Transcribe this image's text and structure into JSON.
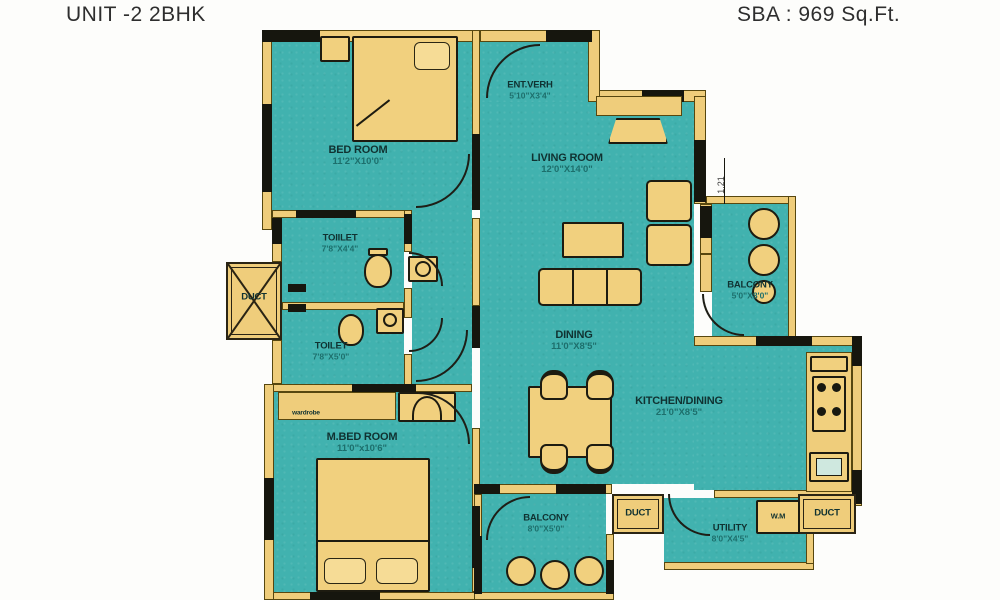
{
  "header": {
    "title": "UNIT -2 2BHK",
    "sba": "SBA : 969 Sq.Ft."
  },
  "colors": {
    "floor_teal": "#41b2af",
    "wall_yellow": "#efcd7b",
    "wall_black": "#16160e",
    "outline_brown": "#57470f",
    "room_label": "#103231",
    "dim_label": "#1d6f6c"
  },
  "rooms": {
    "bedroom": {
      "name": "BED ROOM",
      "dims": "11'2\"X10'0\""
    },
    "entverh": {
      "name": "ENT.VERH",
      "dims": "5'10\"X3'4\""
    },
    "living": {
      "name": "LIVING ROOM",
      "dims": "12'0\"X14'0\""
    },
    "toilet1": {
      "name": "TOIILET",
      "dims": "7'8\"X4'4\""
    },
    "toilet2": {
      "name": "TOILET",
      "dims": "7'8\"X5'0\""
    },
    "duct_left": {
      "name": "DUCT"
    },
    "balcony_right": {
      "name": "BALCONY",
      "dims": "5'0\"X8'0\""
    },
    "dining": {
      "name": "DINING",
      "dims": "11'0\"X8'5\""
    },
    "kitchen": {
      "name": "KITCHEN/DINING",
      "dims": "21'0\"X8'5\""
    },
    "mbed": {
      "name": "M.BED ROOM",
      "dims": "11'0\"x10'6\""
    },
    "wardrobe": {
      "name": "wardrobe"
    },
    "balcony_bottom": {
      "name": "BALCONY",
      "dims": "8'0\"X5'0\""
    },
    "duct_bottom": {
      "name": "DUCT"
    },
    "utility": {
      "name": "UTILITY",
      "dims": "8'0\"X4'5\""
    },
    "wm": {
      "name": "W.M"
    },
    "duct_br": {
      "name": "DUCT"
    },
    "dim_marker": {
      "value": "1.21"
    }
  }
}
